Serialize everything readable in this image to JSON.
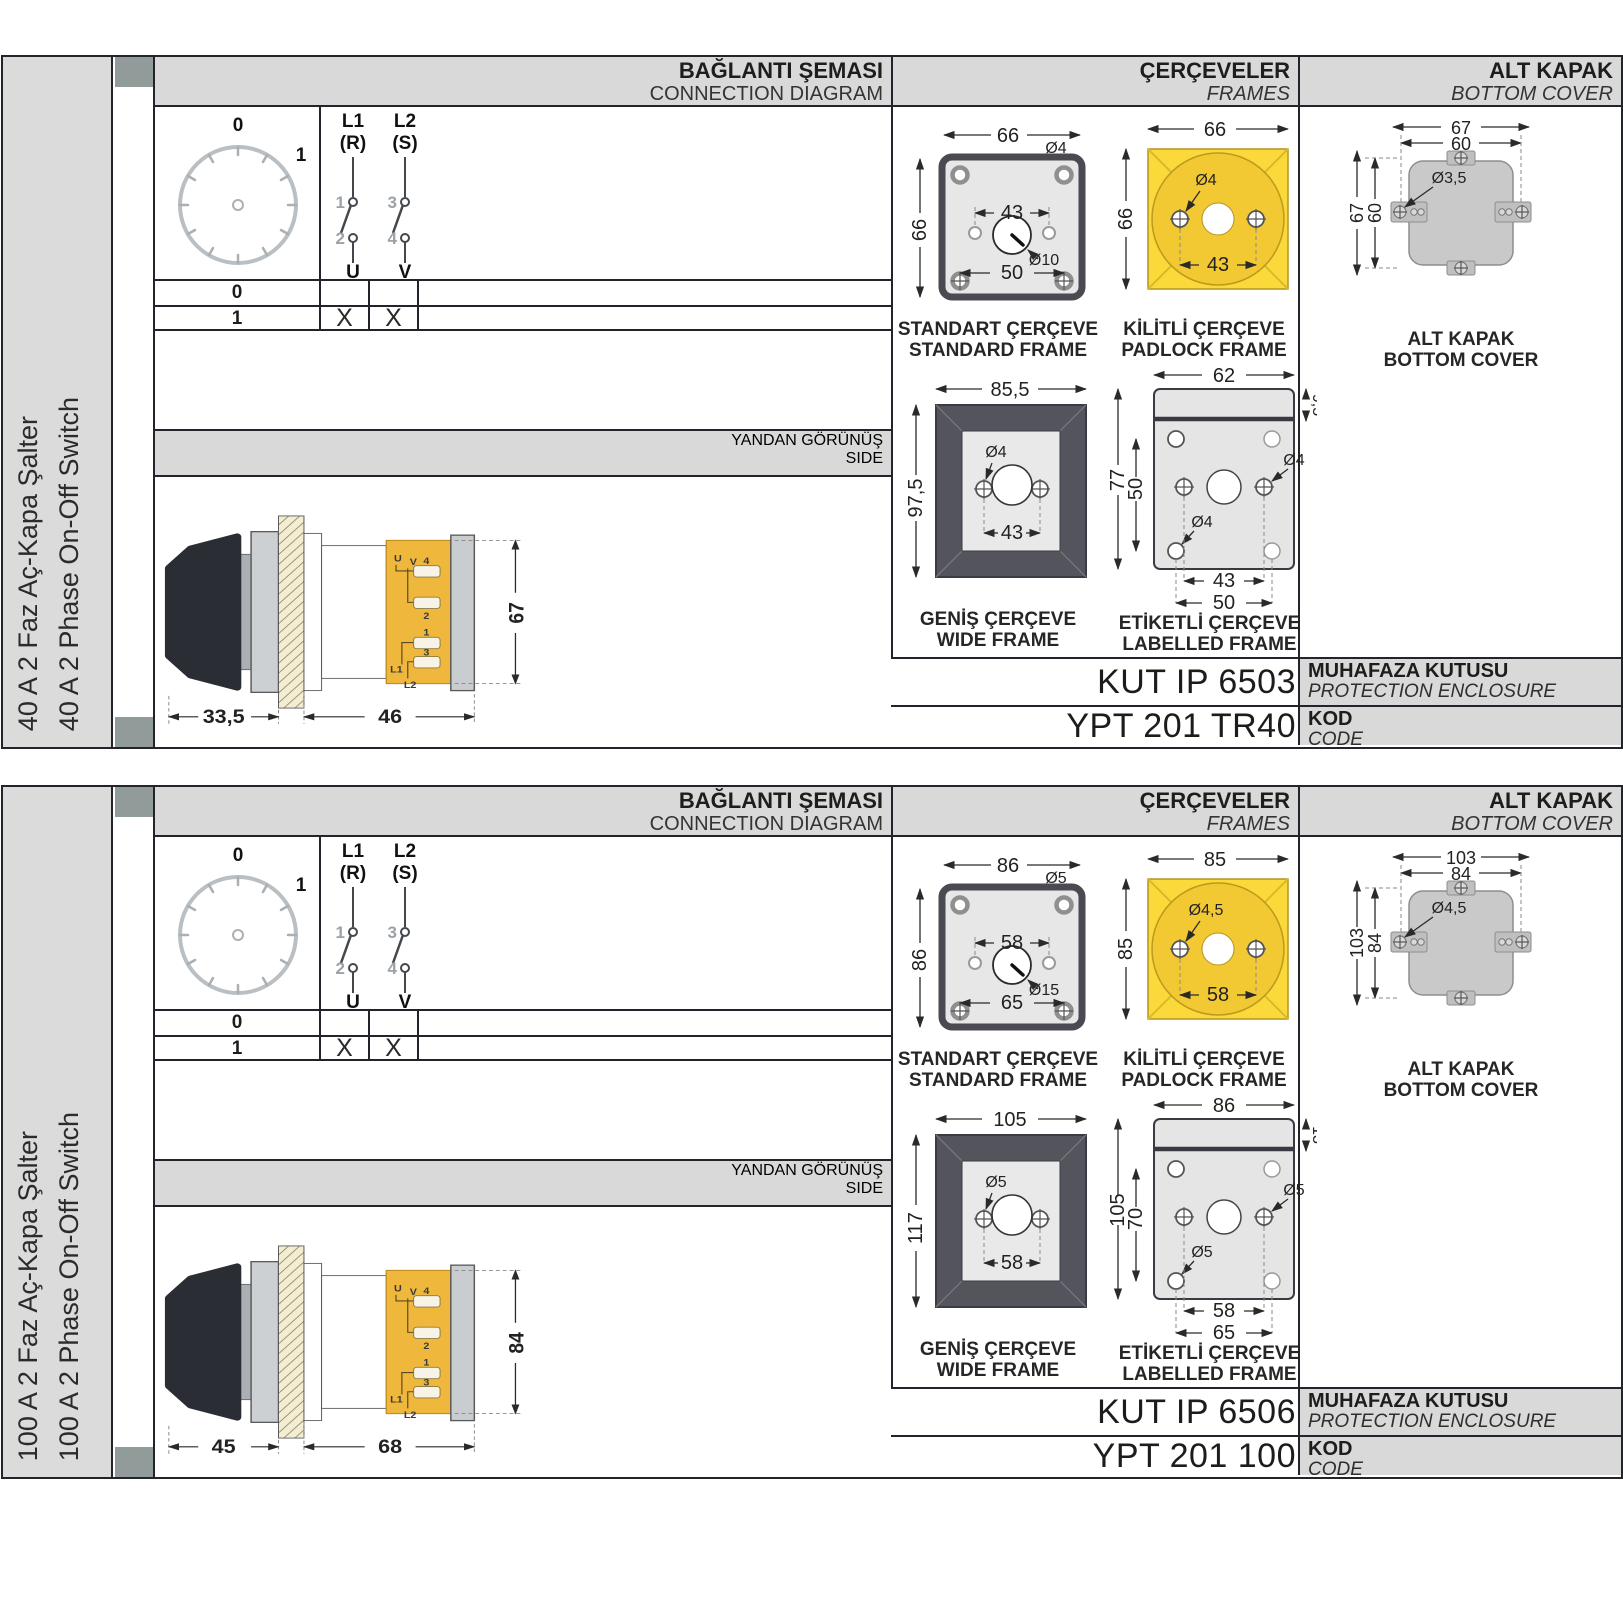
{
  "sections": [
    {
      "side_label_tr": "40 A 2 Faz Aç-Kapa Şalter",
      "side_label_en": "40 A 2 Phase On-Off Switch",
      "headers": {
        "connection_tr": "BAĞLANTI ŞEMASI",
        "connection_en": "CONNECTION DIAGRAM",
        "frames_tr": "ÇERÇEVELER",
        "frames_en": "FRAMES",
        "cover_tr": "ALT KAPAK",
        "cover_en": "BOTTOM COVER"
      },
      "connection": {
        "pos_off": "0",
        "pos_on": "1",
        "pole1_line": "L1",
        "pole1_phase": "(R)",
        "pole2_line": "L2",
        "pole2_phase": "(S)",
        "contact1": "1",
        "contact2": "2",
        "contact3": "3",
        "contact4": "4",
        "terminal1": "U",
        "terminal2": "V",
        "rows": [
          {
            "pos": "0",
            "u": "",
            "v": ""
          },
          {
            "pos": "1",
            "u": "X",
            "v": "X"
          }
        ]
      },
      "side_view": {
        "title_tr": "YANDAN GÖRÜNÜŞ",
        "title_en": "SIDE",
        "dim_handle": "33,5",
        "dim_body": "46",
        "dim_height": "67",
        "t_u": "U",
        "t_v": "V",
        "t_4": "4",
        "t_2": "2",
        "t_1": "1",
        "t_3": "3",
        "t_l1": "L1",
        "t_l2": "L2"
      },
      "standard_frame": {
        "caption_tr": "STANDART ÇERÇEVE",
        "caption_en": "STANDARD FRAME",
        "dim_width": "66",
        "dim_height": "66",
        "dim_hole": "Ø4",
        "dim_inner": "43",
        "dim_center_hole": "Ø10",
        "dim_outer": "50"
      },
      "padlock_frame": {
        "caption_tr": "KİLİTLİ ÇERÇEVE",
        "caption_en": "PADLOCK FRAME",
        "dim_width": "66",
        "dim_height": "66",
        "dim_hole": "Ø4",
        "dim_inner": "43"
      },
      "wide_frame": {
        "caption_tr": "GENİŞ ÇERÇEVE",
        "caption_en": "WIDE FRAME",
        "dim_width": "85,5",
        "dim_height": "97,5",
        "dim_hole": "Ø4",
        "dim_inner": "43"
      },
      "labelled_frame": {
        "caption_tr": "ETİKETLİ ÇERÇEVE",
        "caption_en": "LABELLED FRAME",
        "dim_width": "62",
        "dim_strip": "9,5",
        "dim_height": "77",
        "dim_inner_h": "50",
        "dim_hole_right": "Ø4",
        "dim_hole_left": "Ø4",
        "dim_inner_w": "43",
        "dim_outer_w": "50"
      },
      "bottom_cover": {
        "caption_tr": "ALT KAPAK",
        "caption_en": "BOTTOM COVER",
        "dim_outer_w": "67",
        "dim_inner_w": "60",
        "dim_outer_h": "67",
        "dim_inner_h": "60",
        "dim_hole": "Ø3,5"
      },
      "enclosure": {
        "value": "KUT IP 6503",
        "label_tr": "MUHAFAZA KUTUSU",
        "label_en": "PROTECTION ENCLOSURE"
      },
      "code": {
        "value": "YPT 201 TR40",
        "label_tr": "KOD",
        "label_en": "CODE"
      }
    },
    {
      "side_label_tr": "100 A 2 Faz Aç-Kapa Şalter",
      "side_label_en": "100 A 2 Phase On-Off Switch",
      "headers": {
        "connection_tr": "BAĞLANTI ŞEMASI",
        "connection_en": "CONNECTION DIAGRAM",
        "frames_tr": "ÇERÇEVELER",
        "frames_en": "FRAMES",
        "cover_tr": "ALT KAPAK",
        "cover_en": "BOTTOM COVER"
      },
      "connection": {
        "pos_off": "0",
        "pos_on": "1",
        "pole1_line": "L1",
        "pole1_phase": "(R)",
        "pole2_line": "L2",
        "pole2_phase": "(S)",
        "contact1": "1",
        "contact2": "2",
        "contact3": "3",
        "contact4": "4",
        "terminal1": "U",
        "terminal2": "V",
        "rows": [
          {
            "pos": "0",
            "u": "",
            "v": ""
          },
          {
            "pos": "1",
            "u": "X",
            "v": "X"
          }
        ]
      },
      "side_view": {
        "title_tr": "YANDAN GÖRÜNÜŞ",
        "title_en": "SIDE",
        "dim_handle": "45",
        "dim_body": "68",
        "dim_height": "84",
        "t_u": "U",
        "t_v": "V",
        "t_4": "4",
        "t_2": "2",
        "t_1": "1",
        "t_3": "3",
        "t_l1": "L1",
        "t_l2": "L2"
      },
      "standard_frame": {
        "caption_tr": "STANDART ÇERÇEVE",
        "caption_en": "STANDARD FRAME",
        "dim_width": "86",
        "dim_height": "86",
        "dim_hole": "Ø5",
        "dim_inner": "58",
        "dim_center_hole": "Ø15",
        "dim_outer": "65"
      },
      "padlock_frame": {
        "caption_tr": "KİLİTLİ ÇERÇEVE",
        "caption_en": "PADLOCK FRAME",
        "dim_width": "85",
        "dim_height": "85",
        "dim_hole": "Ø4,5",
        "dim_inner": "58"
      },
      "wide_frame": {
        "caption_tr": "GENİŞ ÇERÇEVE",
        "caption_en": "WIDE FRAME",
        "dim_width": "105",
        "dim_height": "117",
        "dim_hole": "Ø5",
        "dim_inner": "58"
      },
      "labelled_frame": {
        "caption_tr": "ETİKETLİ ÇERÇEVE",
        "caption_en": "LABELLED FRAME",
        "dim_width": "86",
        "dim_strip": "13",
        "dim_height": "105",
        "dim_inner_h": "70",
        "dim_hole_right": "Ø5",
        "dim_hole_left": "Ø5",
        "dim_inner_w": "58",
        "dim_outer_w": "65"
      },
      "bottom_cover": {
        "caption_tr": "ALT KAPAK",
        "caption_en": "BOTTOM COVER",
        "dim_outer_w": "103",
        "dim_inner_w": "84",
        "dim_outer_h": "103",
        "dim_inner_h": "84",
        "dim_hole": "Ø4,5"
      },
      "enclosure": {
        "value": "KUT IP 6506",
        "label_tr": "MUHAFAZA KUTUSU",
        "label_en": "PROTECTION ENCLOSURE"
      },
      "code": {
        "value": "YPT 201 100",
        "label_tr": "KOD",
        "label_en": "CODE"
      }
    }
  ]
}
